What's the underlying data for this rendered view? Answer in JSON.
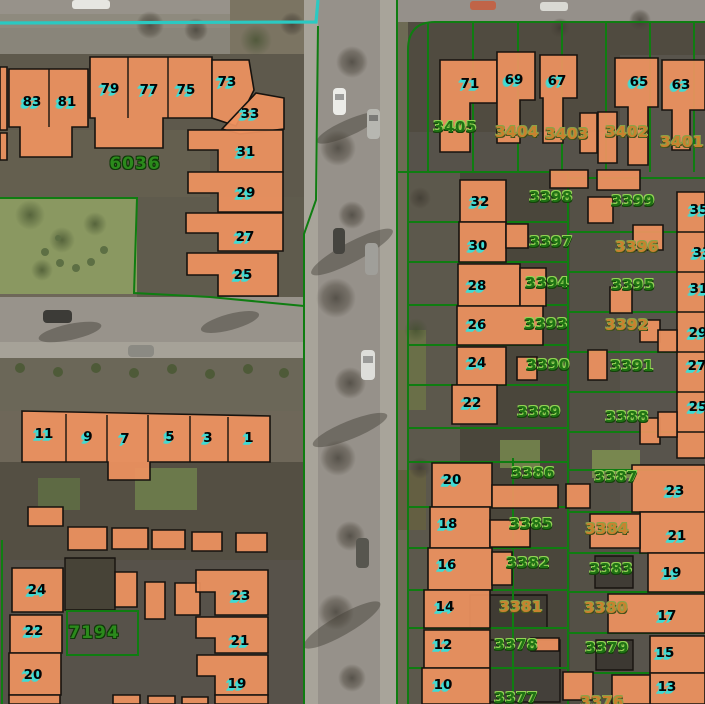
{
  "map": {
    "description": "aerial cadastral map with building footprints and parcel numbers",
    "colors": {
      "building": "#ee9260",
      "building_outline": "#17130f",
      "parcel_line": "#0f7d11",
      "survey_line": "#2bc9c2",
      "house_number_shadow": "#3cdcd6",
      "parcel_text_green": "#1f7314",
      "parcel_text_orange": "#c8822f"
    },
    "survey_line": {
      "path": "M0,23 L316,22 L318,0"
    },
    "parcel_lines": [
      "M318,26 L316,200 L304,234 L304,704",
      "M397,0 L397,704",
      "M408,704 L408,50 Q408,22 435,22 L705,22",
      "M0,198 L137,198 L134,293 L210,297 L304,306",
      "M67,611 L138,611 L138,655 L67,655 Z",
      "M2,540 L2,704",
      "M568,172 L568,704",
      "M513,458 L513,704",
      "M397,172 L568,172",
      "M408,222 L568,222",
      "M408,262 L568,262",
      "M408,305 L568,305",
      "M408,345 L568,345",
      "M408,385 L568,385",
      "M408,428 L568,428",
      "M408,462 L568,462",
      "M408,507 L568,507",
      "M408,548 L568,548",
      "M408,590 L568,590",
      "M408,628 L568,628",
      "M408,668 L568,668",
      "M568,178 L705,178",
      "M568,232 L705,232",
      "M568,272 L705,272",
      "M568,312 L705,312",
      "M568,352 L705,352",
      "M568,392 L705,392",
      "M568,432 L705,432",
      "M568,470 L705,470",
      "M568,512 L705,512",
      "M568,553 L705,553",
      "M568,592 L705,592",
      "M568,633 L705,633",
      "M568,673 L705,673",
      "M428,22 L428,172",
      "M473,22 L473,172",
      "M518,22 L518,172",
      "M562,22 L562,172",
      "M606,22 L606,172",
      "M650,22 L650,172",
      "M694,22 L694,172"
    ],
    "outlined_roofs": [
      {
        "p": "470,595 547,595 547,628 470,628",
        "f": "#3f3b33"
      },
      {
        "p": "490,640 560,640 560,702 490,702",
        "f": "#44403a"
      },
      {
        "p": "595,556 633,556 633,588 595,588",
        "f": "#403c35"
      },
      {
        "p": "596,640 633,640 633,670 596,670",
        "f": "#3c3832"
      },
      {
        "p": "65,558 115,558 115,610 65,610",
        "f": "#474337"
      }
    ],
    "buildings": [
      "0,67 7,67 7,130 0,130",
      "0,133 7,133 7,160 0,160",
      "9,69 88,69 88,127 72,127 72,157 20,157 20,127 9,127",
      "90,57 212,57 212,118 163,118 163,148 95,148 95,118 90,118",
      "212,60 249,60 254,90 236,126 212,118",
      "222,129 256,93 284,98 284,129 240,134",
      "188,130 283,130 283,172 218,172 218,150 188,150",
      "188,172 283,172 283,212 218,212 218,193 188,193",
      "186,213 283,213 283,251 218,251 218,233 186,233",
      "187,253 278,253 278,296 218,296 218,275 187,275",
      "22,411 270,416 270,462 150,462 150,480 108,480 108,462 22,462",
      "28,507 63,507 63,526 28,526",
      "68,527 107,527 107,550 68,550",
      "112,528 148,528 148,549 112,549",
      "152,530 185,530 185,549 152,549",
      "192,532 222,532 222,551 192,551",
      "236,533 267,533 267,552 236,552",
      "12,568 63,568 63,612 12,612",
      "10,615 62,615 62,653 10,653",
      "9,653 61,653 61,695 9,695",
      "9,695 60,695 60,704 9,704",
      "115,572 137,572 137,607 115,607",
      "145,582 165,582 165,619 145,619",
      "175,583 200,583 200,615 175,615",
      "113,695 140,695 140,704 113,704",
      "148,696 175,696 175,704 148,704",
      "182,697 208,697 208,704 182,704",
      "196,570 268,570 268,615 215,615 215,592 196,592",
      "196,617 268,617 268,653 215,653 215,638 196,638",
      "197,655 268,655 268,695 215,695 215,676 197,676",
      "215,695 268,695 268,704 215,704",
      "440,60 497,60 497,103 470,103 470,152 440,152",
      "497,52 535,52 535,100 520,100 520,143 497,143",
      "540,55 577,55 577,98 563,98 563,143 543,143 543,98 540,98",
      "580,113 597,113 597,153 580,153",
      "615,58 658,58 658,107 648,107 648,165 628,165 628,107 615,107",
      "598,112 617,112 617,163 598,163",
      "662,60 705,60 705,110 690,110 690,150 672,150 672,110 662,110",
      "460,180 506,180 506,222 460,222",
      "459,222 506,222 506,262 459,262",
      "506,224 528,224 528,248 506,248",
      "458,264 520,264 520,306 458,306",
      "520,268 546,268 546,306 520,306",
      "457,306 543,306 543,345 457,345",
      "457,347 506,347 506,385 457,385",
      "452,385 497,385 497,424 452,424",
      "550,170 588,170 588,188 550,188",
      "597,170 640,170 640,190 597,190",
      "588,197 613,197 613,223 588,223",
      "633,225 663,225 663,250 633,250",
      "610,287 632,287 632,313 610,313",
      "517,357 537,357 537,380 517,380",
      "588,350 607,350 607,380 588,380",
      "640,320 660,320 660,342 640,342",
      "640,418 660,418 660,444 640,444",
      "677,192 705,192 705,458 677,458",
      "658,330 677,330 677,352 658,352",
      "658,412 677,412 677,437 658,437",
      "432,463 492,463 492,507 432,507",
      "492,485 558,485 558,508 492,508",
      "430,507 490,507 490,548 430,548",
      "490,520 530,520 530,547 490,547",
      "428,548 492,548 492,590 428,590",
      "492,552 512,552 512,585 492,585",
      "424,590 490,590 490,628 424,628",
      "424,630 490,630 490,668 424,668",
      "422,668 490,668 490,704 422,704",
      "566,484 590,484 590,508 566,508",
      "531,638 559,638 559,651 531,651",
      "563,672 593,672 593,700 563,700",
      "632,465 705,465 705,512 632,512",
      "640,512 705,512 705,553 640,553",
      "590,514 640,514 640,548 590,548",
      "648,553 705,553 705,592 648,592",
      "608,594 705,594 705,633 608,633",
      "650,636 705,636 705,673 650,673",
      "650,673 705,673 705,704 650,704",
      "612,675 650,675 650,704 612,704"
    ],
    "building_dividers": [
      "M49,69 L49,127",
      "M128,57 L128,118",
      "M168,57 L168,118",
      "M66,414 L66,462",
      "M107,415 L107,462",
      "M148,415 L148,462",
      "M190,416 L190,462",
      "M228,417 L228,462",
      "M677,232 L705,232",
      "M677,272 L705,272",
      "M677,312 L705,312",
      "M677,352 L705,352",
      "M677,392 L705,392",
      "M677,432 L705,432"
    ],
    "house_numbers": [
      {
        "t": "83",
        "x": 32,
        "y": 102
      },
      {
        "t": "81",
        "x": 67,
        "y": 102
      },
      {
        "t": "79",
        "x": 110,
        "y": 89
      },
      {
        "t": "77",
        "x": 149,
        "y": 90
      },
      {
        "t": "75",
        "x": 186,
        "y": 90
      },
      {
        "t": "73",
        "x": 227,
        "y": 82
      },
      {
        "t": "33",
        "x": 250,
        "y": 114
      },
      {
        "t": "31",
        "x": 246,
        "y": 152
      },
      {
        "t": "29",
        "x": 246,
        "y": 193
      },
      {
        "t": "27",
        "x": 245,
        "y": 237
      },
      {
        "t": "25",
        "x": 243,
        "y": 275
      },
      {
        "t": "11",
        "x": 44,
        "y": 434
      },
      {
        "t": "9",
        "x": 88,
        "y": 437
      },
      {
        "t": "7",
        "x": 125,
        "y": 439
      },
      {
        "t": "5",
        "x": 170,
        "y": 437
      },
      {
        "t": "3",
        "x": 208,
        "y": 438
      },
      {
        "t": "1",
        "x": 249,
        "y": 438
      },
      {
        "t": "24",
        "x": 37,
        "y": 590
      },
      {
        "t": "22",
        "x": 34,
        "y": 631
      },
      {
        "t": "20",
        "x": 33,
        "y": 675
      },
      {
        "t": "23",
        "x": 241,
        "y": 596
      },
      {
        "t": "21",
        "x": 240,
        "y": 641
      },
      {
        "t": "19",
        "x": 237,
        "y": 684
      },
      {
        "t": "71",
        "x": 470,
        "y": 84
      },
      {
        "t": "69",
        "x": 514,
        "y": 80
      },
      {
        "t": "67",
        "x": 557,
        "y": 81
      },
      {
        "t": "65",
        "x": 639,
        "y": 82
      },
      {
        "t": "63",
        "x": 681,
        "y": 85
      },
      {
        "t": "32",
        "x": 480,
        "y": 202
      },
      {
        "t": "30",
        "x": 478,
        "y": 246
      },
      {
        "t": "28",
        "x": 477,
        "y": 286
      },
      {
        "t": "26",
        "x": 477,
        "y": 325
      },
      {
        "t": "24",
        "x": 477,
        "y": 363
      },
      {
        "t": "22",
        "x": 472,
        "y": 403
      },
      {
        "t": "20",
        "x": 452,
        "y": 480
      },
      {
        "t": "18",
        "x": 448,
        "y": 524
      },
      {
        "t": "16",
        "x": 447,
        "y": 565
      },
      {
        "t": "14",
        "x": 445,
        "y": 607
      },
      {
        "t": "12",
        "x": 443,
        "y": 645
      },
      {
        "t": "10",
        "x": 443,
        "y": 685
      },
      {
        "t": "35",
        "x": 699,
        "y": 210
      },
      {
        "t": "33",
        "x": 702,
        "y": 253
      },
      {
        "t": "31",
        "x": 699,
        "y": 289
      },
      {
        "t": "29",
        "x": 698,
        "y": 333
      },
      {
        "t": "27",
        "x": 697,
        "y": 366
      },
      {
        "t": "25",
        "x": 698,
        "y": 407
      },
      {
        "t": "23",
        "x": 675,
        "y": 491
      },
      {
        "t": "21",
        "x": 677,
        "y": 536
      },
      {
        "t": "19",
        "x": 672,
        "y": 573
      },
      {
        "t": "17",
        "x": 667,
        "y": 616
      },
      {
        "t": "15",
        "x": 665,
        "y": 653
      },
      {
        "t": "13",
        "x": 667,
        "y": 687
      }
    ],
    "parcel_numbers": [
      {
        "t": "6036",
        "x": 135,
        "y": 164,
        "variant": "big"
      },
      {
        "t": "7194",
        "x": 94,
        "y": 633,
        "variant": "big"
      },
      {
        "t": "3405",
        "x": 455,
        "y": 127,
        "variant": "green"
      },
      {
        "t": "3404",
        "x": 517,
        "y": 132,
        "variant": "orange"
      },
      {
        "t": "3403",
        "x": 567,
        "y": 134,
        "variant": "orange"
      },
      {
        "t": "3402",
        "x": 627,
        "y": 132,
        "variant": "orange"
      },
      {
        "t": "3401",
        "x": 682,
        "y": 142,
        "variant": "orange"
      },
      {
        "t": "3398",
        "x": 551,
        "y": 197,
        "variant": "green"
      },
      {
        "t": "3399",
        "x": 633,
        "y": 201,
        "variant": "green"
      },
      {
        "t": "3397",
        "x": 551,
        "y": 242,
        "variant": "green"
      },
      {
        "t": "3396",
        "x": 637,
        "y": 247,
        "variant": "orange"
      },
      {
        "t": "3394",
        "x": 547,
        "y": 283,
        "variant": "green"
      },
      {
        "t": "3395",
        "x": 633,
        "y": 285,
        "variant": "green"
      },
      {
        "t": "3393",
        "x": 546,
        "y": 324,
        "variant": "green"
      },
      {
        "t": "3392",
        "x": 627,
        "y": 325,
        "variant": "orange"
      },
      {
        "t": "3390",
        "x": 548,
        "y": 365,
        "variant": "green"
      },
      {
        "t": "3391",
        "x": 632,
        "y": 366,
        "variant": "green"
      },
      {
        "t": "3389",
        "x": 539,
        "y": 412,
        "variant": "green"
      },
      {
        "t": "3388",
        "x": 627,
        "y": 417,
        "variant": "green"
      },
      {
        "t": "3386",
        "x": 533,
        "y": 473,
        "variant": "green"
      },
      {
        "t": "3387",
        "x": 616,
        "y": 477,
        "variant": "green"
      },
      {
        "t": "3385",
        "x": 531,
        "y": 524,
        "variant": "green"
      },
      {
        "t": "3384",
        "x": 607,
        "y": 529,
        "variant": "orange"
      },
      {
        "t": "3382",
        "x": 528,
        "y": 563,
        "variant": "green"
      },
      {
        "t": "3383",
        "x": 611,
        "y": 569,
        "variant": "green"
      },
      {
        "t": "3381",
        "x": 521,
        "y": 607,
        "variant": "orange"
      },
      {
        "t": "3380",
        "x": 606,
        "y": 608,
        "variant": "orange"
      },
      {
        "t": "3378",
        "x": 516,
        "y": 645,
        "variant": "green"
      },
      {
        "t": "3379",
        "x": 607,
        "y": 648,
        "variant": "green"
      },
      {
        "t": "3377",
        "x": 516,
        "y": 698,
        "variant": "green"
      },
      {
        "t": "3376",
        "x": 602,
        "y": 702,
        "variant": "orange"
      }
    ]
  }
}
